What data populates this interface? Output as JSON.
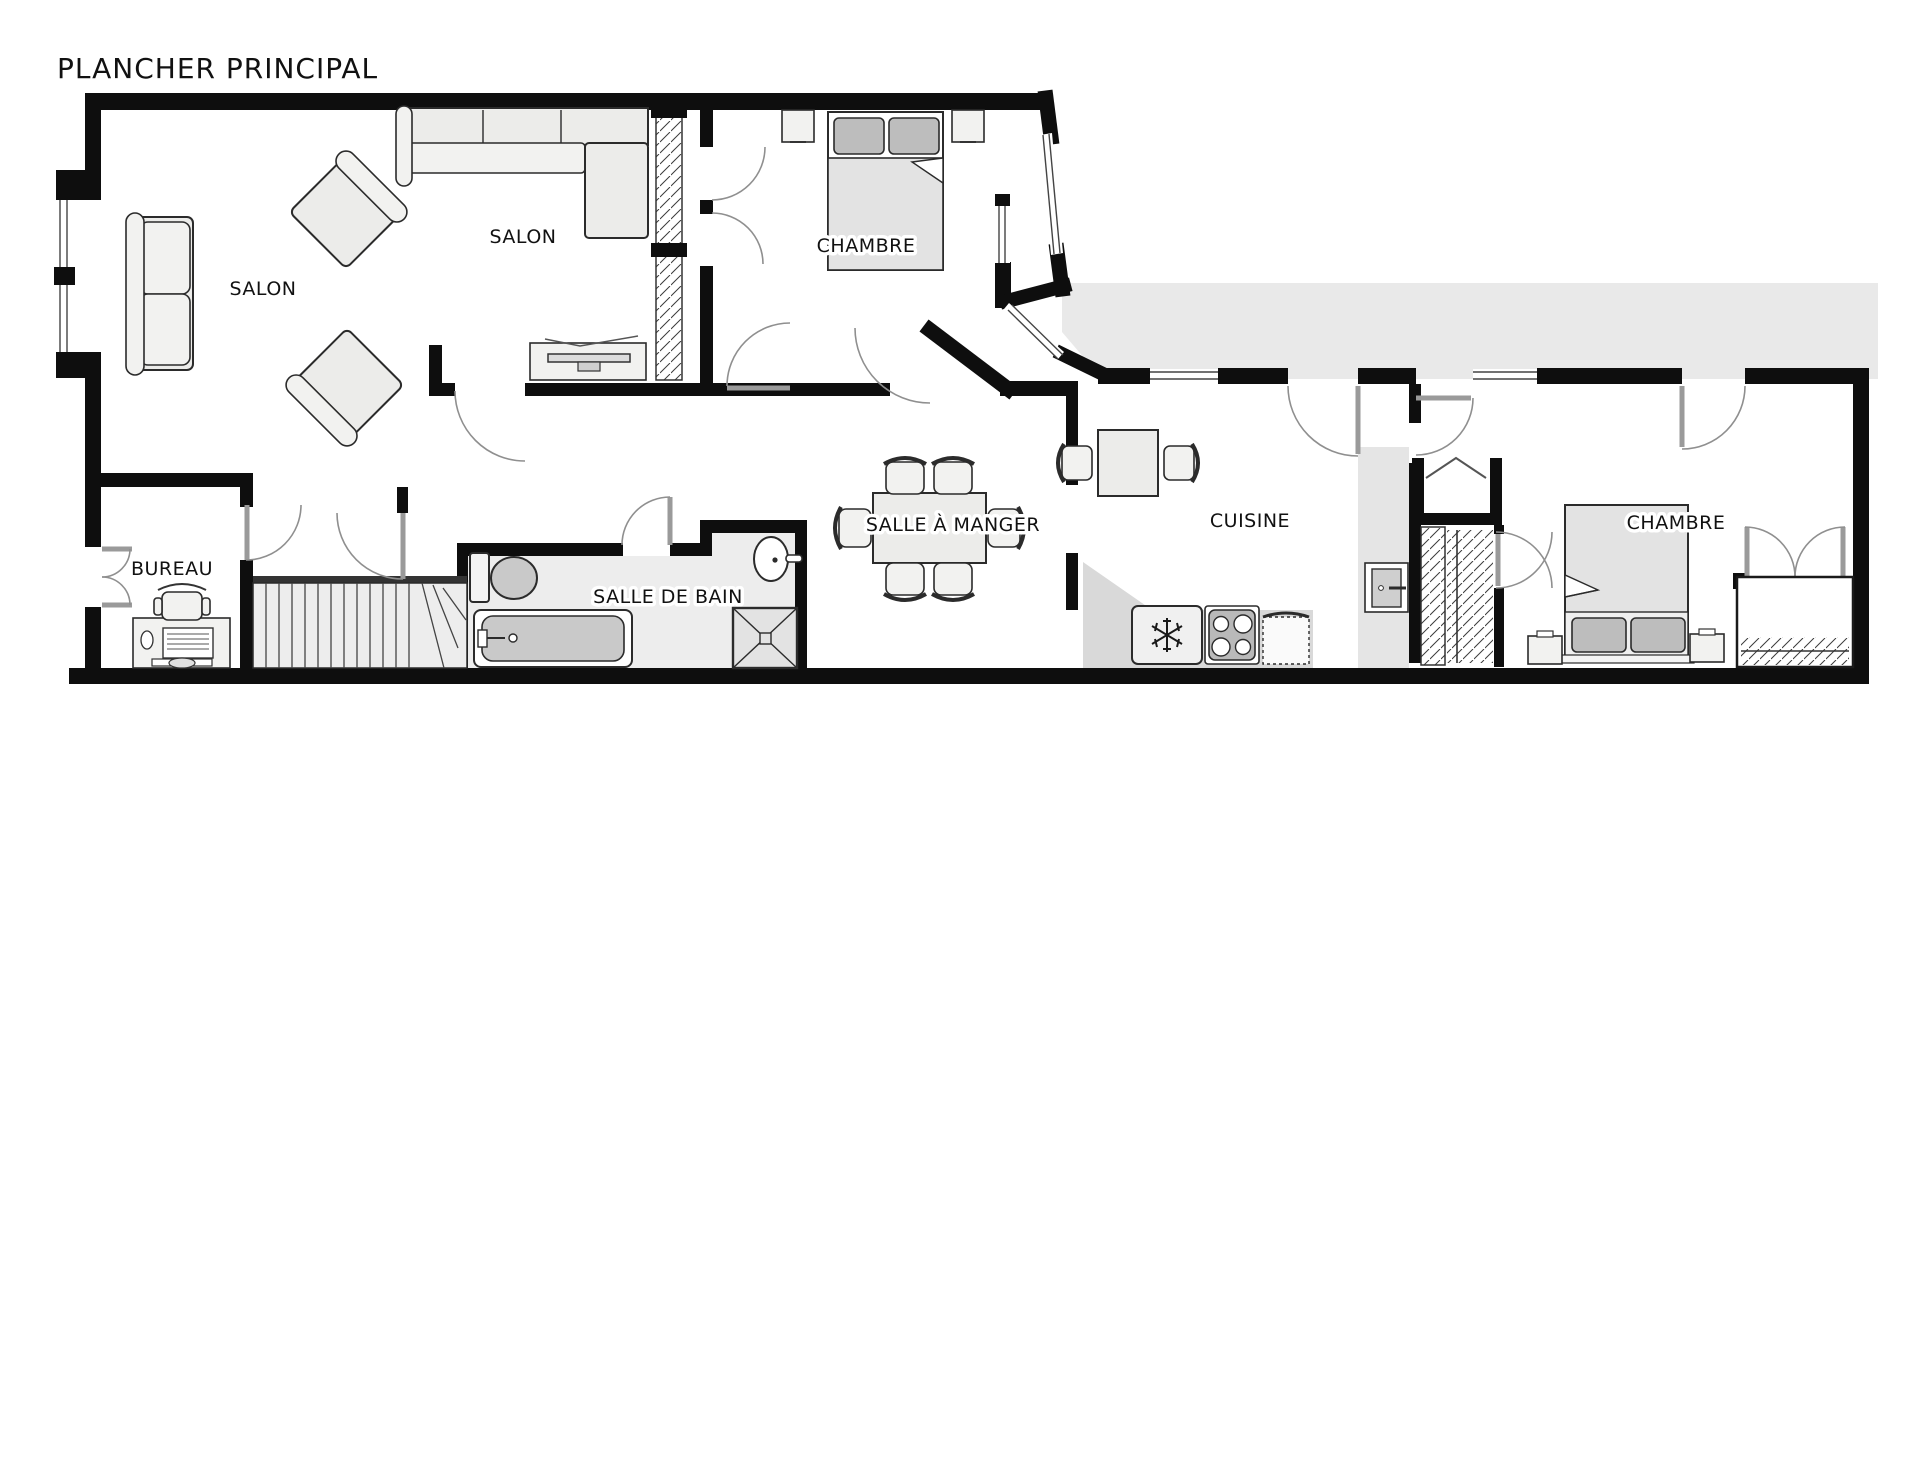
{
  "title": "PLANCHER PRINCIPAL",
  "rooms": [
    {
      "id": "salon-1",
      "label": "SALON",
      "x": 263,
      "y": 295
    },
    {
      "id": "salon-2",
      "label": "SALON",
      "x": 523,
      "y": 243
    },
    {
      "id": "chambre-1",
      "label": "CHAMBRE",
      "x": 866,
      "y": 252
    },
    {
      "id": "bureau",
      "label": "BUREAU",
      "x": 172,
      "y": 575
    },
    {
      "id": "salle-de-bain",
      "label": "SALLE DE BAIN",
      "x": 668,
      "y": 603
    },
    {
      "id": "salle-a-manger",
      "label": "SALLE À MANGER",
      "x": 953,
      "y": 531
    },
    {
      "id": "cuisine",
      "label": "CUISINE",
      "x": 1250,
      "y": 527
    },
    {
      "id": "chambre-2",
      "label": "CHAMBRE",
      "x": 1676,
      "y": 529
    }
  ],
  "colors": {
    "wall": "#0e0e0e",
    "deck": "#e9e9e9",
    "floor_gray": "#ededed",
    "furniture": "#ececea",
    "pillow": "#bdbdbd"
  }
}
